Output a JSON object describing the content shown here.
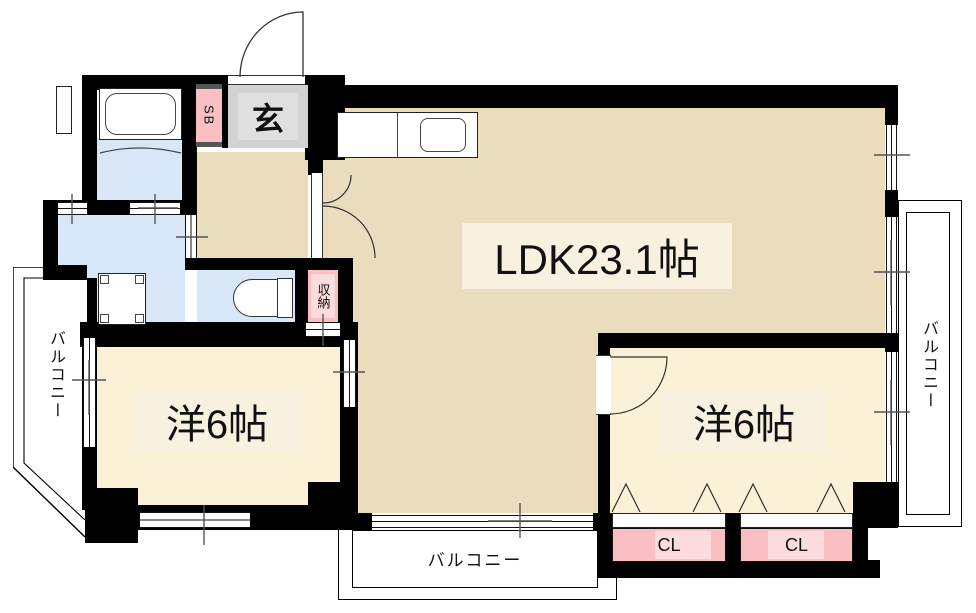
{
  "plan": {
    "title": "apartment-floorplan",
    "rooms": {
      "ldk": {
        "label": "LDK23.1帖"
      },
      "bedroom_left": {
        "label": "洋6帖"
      },
      "bedroom_right": {
        "label": "洋6帖"
      },
      "entrance": {
        "label": "玄"
      },
      "shoe_box": {
        "label": "SB"
      },
      "storage": {
        "label": "収納"
      },
      "closet_1": {
        "label": "CL"
      },
      "closet_2": {
        "label": "CL"
      },
      "balcony_left": {
        "label": "バルコニー"
      },
      "balcony_bottom": {
        "label": "バルコニー"
      },
      "balcony_right": {
        "label": "バルコニー"
      }
    },
    "colors": {
      "floor_main": "#EADDBE",
      "floor_bedroom": "#FAF1D6",
      "water": "#D7E7F8",
      "pink": "#F9BFC3",
      "pink_light": "#FCDCDD",
      "entrance_gray": "#D2D2D2",
      "entrance_gray_light": "#DFDFDF",
      "label_bg": "#F8F1DF",
      "wall": "#000000"
    }
  }
}
